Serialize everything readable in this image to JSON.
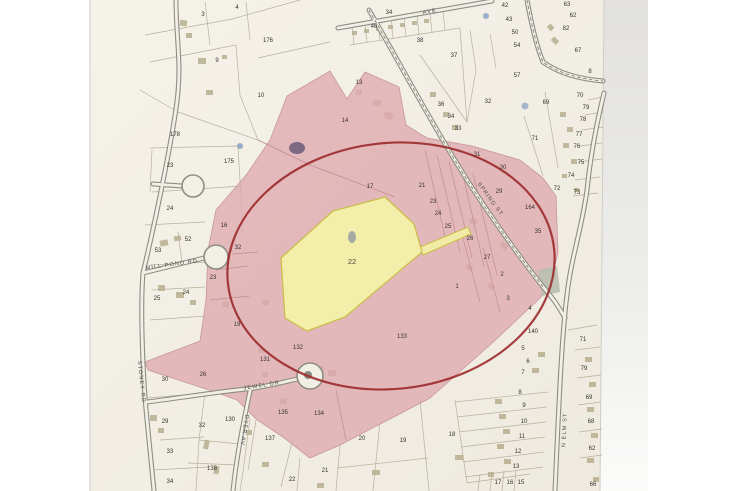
{
  "photo": {
    "kind": "photograph of paper tax assessor parcel map",
    "colors": {
      "paper": "#f3f0e7",
      "highlight_pink": "#dfa9ae",
      "highlight_yellow": "#f3efa5",
      "outline_red": "#9c2a2d",
      "road_gray": "#8d8d86",
      "parcel_line": "#b5ad97"
    }
  },
  "streets": {
    "mill_pond_rd": "MILL POND RD",
    "stoney_rd": "STONEY RD",
    "jewel_dr": "JEWEL DR",
    "dyer_av": "DYER AV",
    "n_elm_st": "N ELM ST",
    "spring_st": "SPRING ST",
    "top_ave": "AVE"
  },
  "lots": [
    "3",
    "4",
    "9",
    "176",
    "10",
    "178",
    "13",
    "14",
    "23",
    "175",
    "24",
    "53",
    "52",
    "16",
    "32",
    "23",
    "24",
    "25",
    "19",
    "30",
    "26",
    "131",
    "132",
    "29",
    "32",
    "130",
    "33",
    "34",
    "138",
    "135",
    "134",
    "137",
    "22",
    "21",
    "20",
    "19",
    "18",
    "17",
    "16",
    "15",
    "17",
    "22",
    "133",
    "40",
    "34",
    "38",
    "37",
    "42",
    "43",
    "50",
    "54",
    "57",
    "63",
    "62",
    "82",
    "67",
    "8",
    "69",
    "70",
    "79",
    "78",
    "77",
    "76",
    "75",
    "74",
    "73",
    "72",
    "71",
    "36",
    "34",
    "33",
    "32",
    "31",
    "30",
    "29",
    "164",
    "21",
    "23",
    "24",
    "25",
    "26",
    "27",
    "35",
    "2",
    "1",
    "3",
    "4",
    "140",
    "5",
    "6",
    "7",
    "8",
    "9",
    "10",
    "11",
    "12",
    "13",
    "71",
    "79",
    "69",
    "68",
    "62",
    "66"
  ]
}
